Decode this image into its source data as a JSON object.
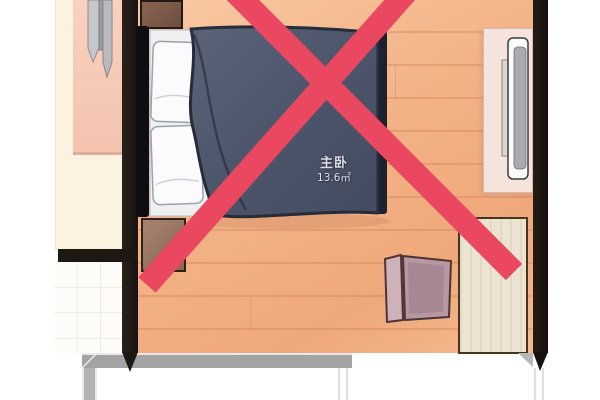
{
  "scene": {
    "kind": "bedroom-floor-plan-illustration",
    "annotation": "red prohibition cross over the whole room"
  },
  "room_label": {
    "name": "主卧",
    "area": "13.6㎡"
  },
  "colors": {
    "accent_cross": "#ea4760",
    "wall_dark": "#1f1813",
    "gray_wall": "#a3a3a3",
    "wood_floor": "#f3b286",
    "adjacent_floor": "#fbf2e0",
    "tile_floor": "#fdfcf8",
    "duvet": "#4d5569",
    "pillow": "#fafbfd",
    "headboard": "#0e0e12",
    "nightstand_top": "#7d5a49",
    "nightstand_bottom": "#98755f",
    "left_cabinet": "#f6cbb7",
    "tv_cabinet": "#f6e4dc",
    "tv_panel": "#a9abb0",
    "door_leaf": "#ece3d0",
    "folding_screen": "#b697a2"
  },
  "furniture": [
    "double-bed",
    "pillow",
    "pillow",
    "duvet",
    "nightstand-top",
    "nightstand-bottom",
    "wardrobe-cabinet-left",
    "tv-cabinet",
    "tv",
    "folding-screen",
    "door-leaf"
  ]
}
